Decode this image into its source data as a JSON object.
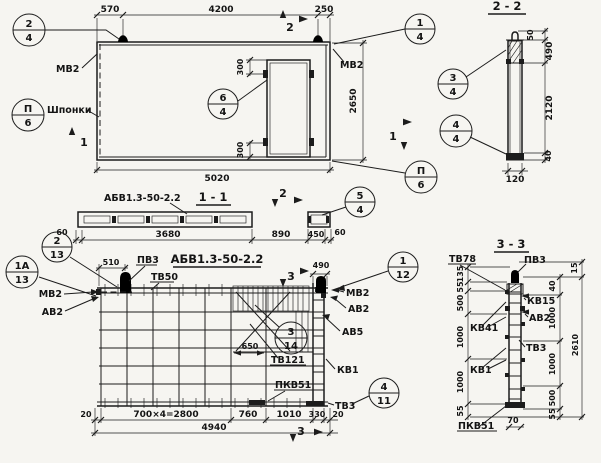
{
  "callouts": {
    "c2_4": {
      "top": "2",
      "bottom": "4"
    },
    "c1_4": {
      "top": "1",
      "bottom": "4"
    },
    "cP6_left": {
      "top": "П",
      "bottom": "6"
    },
    "cP6_right": {
      "top": "П",
      "bottom": "6"
    },
    "c6_4": {
      "top": "6",
      "bottom": "4"
    },
    "c3_4": {
      "top": "3",
      "bottom": "4"
    },
    "c4_4": {
      "top": "4",
      "bottom": "4"
    },
    "c5_4": {
      "top": "5",
      "bottom": "4"
    },
    "c2_13": {
      "top": "2",
      "bottom": "13"
    },
    "c1a_13": {
      "top": "1А",
      "bottom": "13"
    },
    "c1_12": {
      "top": "1",
      "bottom": "12"
    },
    "c3_14": {
      "top": "3",
      "bottom": "14"
    },
    "c4_11": {
      "top": "4",
      "bottom": "11"
    }
  },
  "section_marks": {
    "s1": "1",
    "s2": "2",
    "s3": "3"
  },
  "main_view": {
    "dims": {
      "top_left": "570",
      "top_span": "4200",
      "top_right": "250",
      "height": "2650",
      "width": "5020",
      "opening_top": "300",
      "opening_bottom": "300"
    },
    "labels": {
      "mv2_left": "МВ2",
      "mv2_right": "МВ2",
      "shponki": "Шпонки"
    }
  },
  "section_1_1": {
    "title": "1 - 1",
    "label": "АБВ1.3-50-2.2",
    "dims": {
      "end_left": "60",
      "main": "3680",
      "gap": "890",
      "piece": "450",
      "end_right": "60"
    }
  },
  "section_2_2": {
    "title": "2 - 2",
    "dims": {
      "hook": "50",
      "top_zone": "490",
      "middle": "2120",
      "bottom": "40",
      "width": "120"
    }
  },
  "elevation": {
    "title": "АБВ1.3-50-2.2",
    "dims": {
      "loop_offset": "510",
      "right_offset": "490",
      "opening_width": "650",
      "edge_left": "20",
      "bays": "700×4=2800",
      "d760": "760",
      "d1010": "1010",
      "d330": "330",
      "edge_right": "20",
      "total": "4940"
    },
    "labels": {
      "pv3": "ПВ3",
      "tv50": "ТВ50",
      "mv2_left": "МВ2",
      "av2_left": "АВ2",
      "mv2_right": "МВ2",
      "av2_right": "АВ2",
      "av5": "АВ5",
      "kv1": "КВ1",
      "tv121": "ТВ121",
      "pkv51": "ПКВ51",
      "tv3": "ТВ3"
    }
  },
  "section_3_3": {
    "title": "3 - 3",
    "labels": {
      "tv78": "ТВ78",
      "pv3": "ПВ3",
      "kv15": "КВ15",
      "av2": "АВ2",
      "kv41": "КВ41",
      "tv3": "ТВ3",
      "kv1": "КВ1",
      "pkv51": "ПКВ51"
    },
    "dims_left": {
      "d135": "135",
      "d55_top": "55",
      "d500": "500",
      "d1000_a": "1000",
      "d1000_b": "1000",
      "d55_bottom": "55"
    },
    "dims_right": {
      "d15": "15",
      "d40": "40",
      "d1000_a": "1000",
      "d1000_b": "1000",
      "d500": "500",
      "d55": "55",
      "total": "2610"
    },
    "dims_bottom": {
      "d70": "70"
    }
  }
}
